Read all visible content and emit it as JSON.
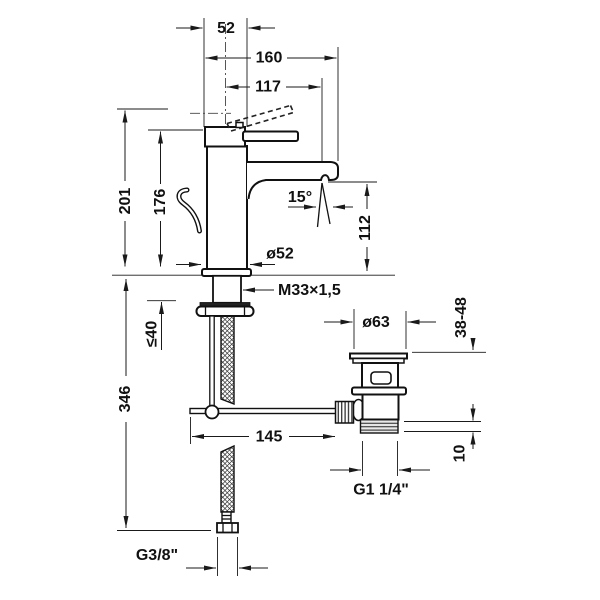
{
  "colors": {
    "line": "#1a1a1a",
    "background": "#ffffff"
  },
  "dims": {
    "cap_width": "52",
    "spout_projection": "160",
    "spout_reach": "117",
    "height_total": "201",
    "height_body": "176",
    "outlet_angle": "15°",
    "outlet_height": "112",
    "body_diameter": "ø52",
    "shank_thread": "M33×1,5",
    "mounting_max": "≤40",
    "hose_length": "346",
    "drain_flange_dia": "ø63",
    "deck_thickness_range": "38-48",
    "rod_length": "145",
    "drain_thread_depth": "10",
    "drain_thread": "G1 1/4\"",
    "hose_thread": "G3/8\""
  }
}
